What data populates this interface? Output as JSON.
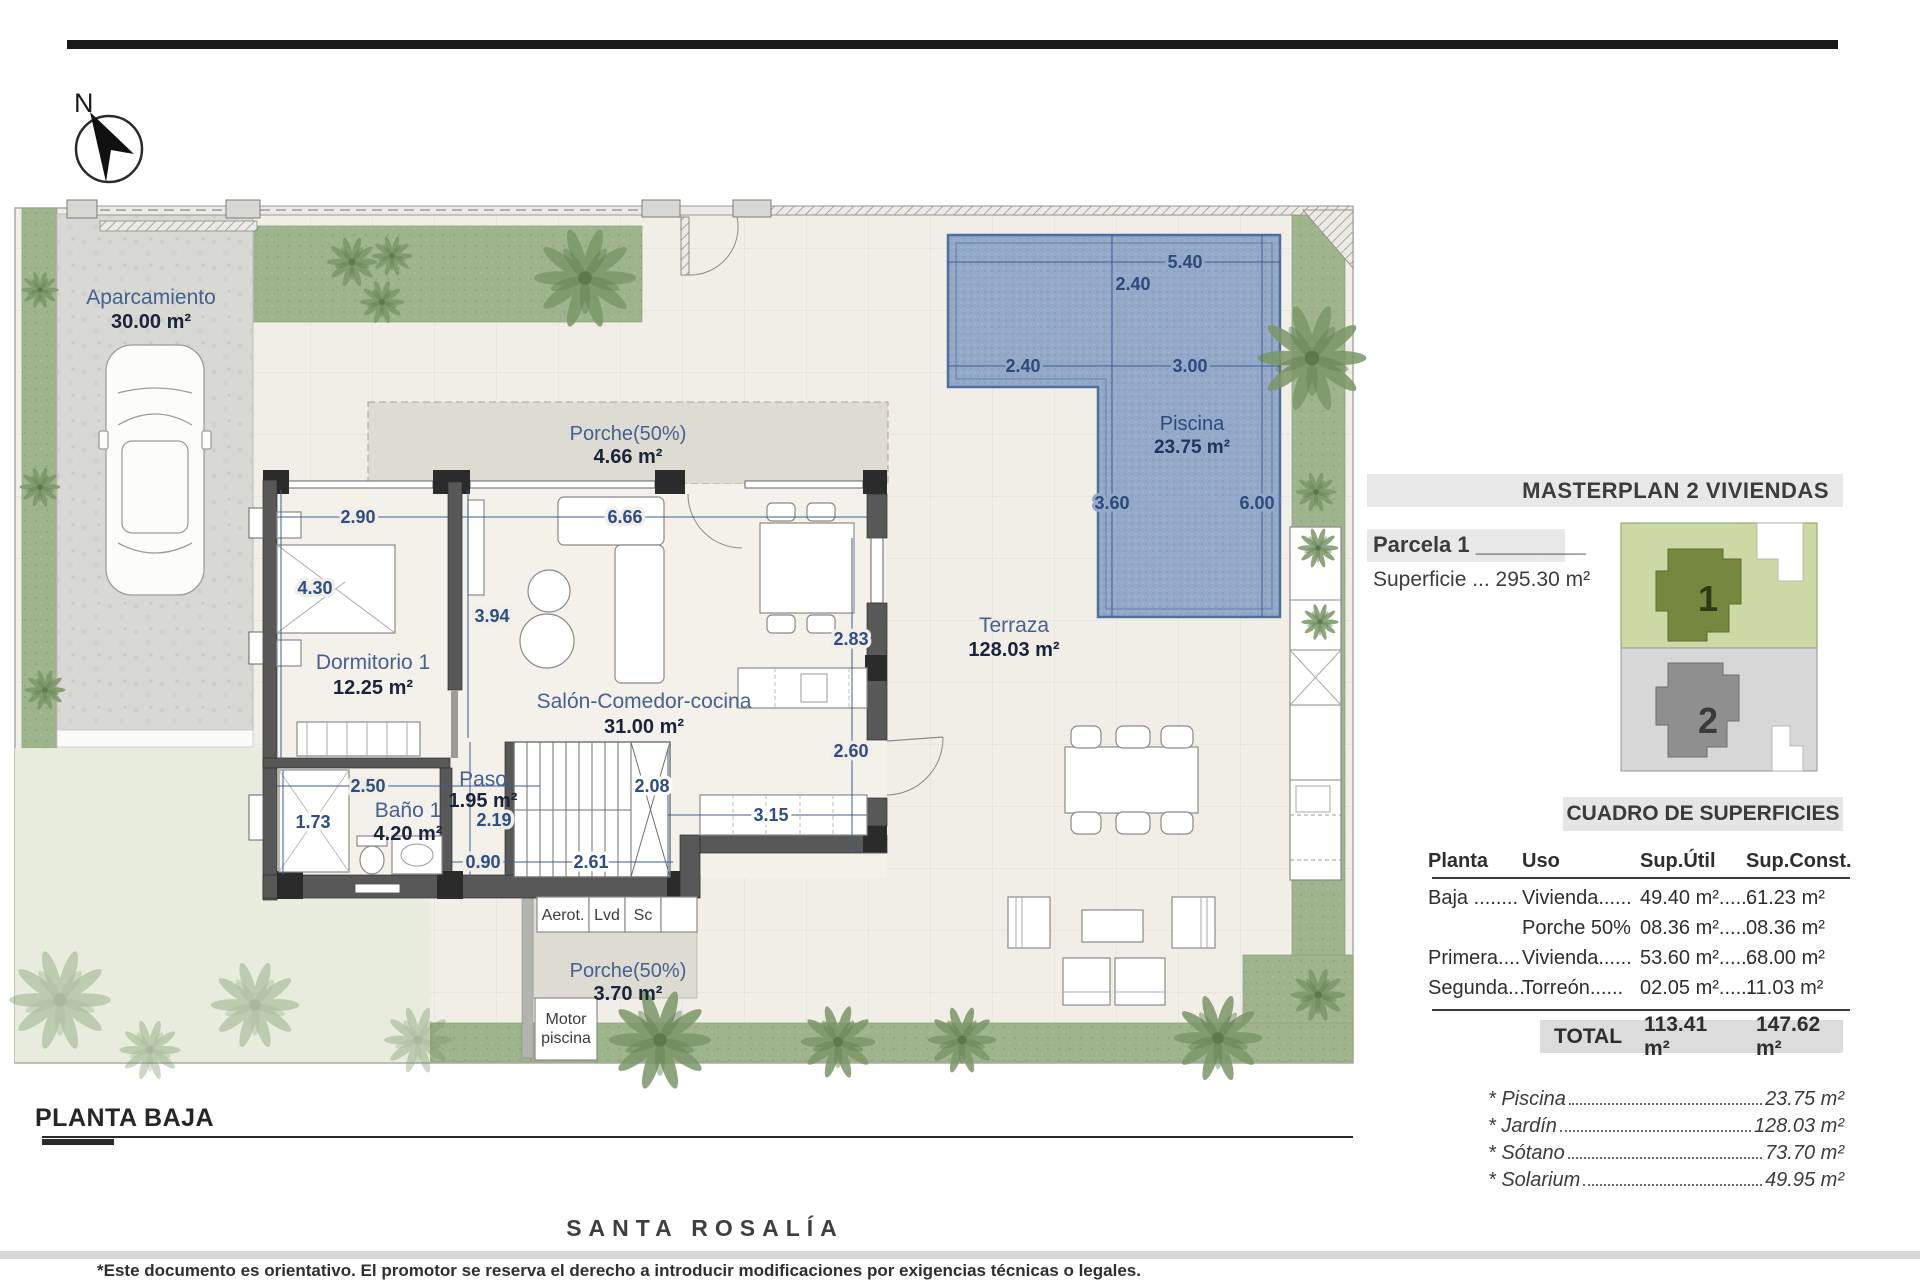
{
  "plan": {
    "north_label": "N",
    "title": "PLANTA BAJA",
    "rooms": {
      "aparcamiento": {
        "name": "Aparcamiento",
        "area": "30.00 m²"
      },
      "porche_norte": {
        "name": "Porche(50%)",
        "area": "4.66 m²"
      },
      "dormitorio": {
        "name": "Dormitorio 1",
        "area": "12.25 m²"
      },
      "salon": {
        "name": "Salón-Comedor-cocina",
        "area": "31.00 m²"
      },
      "bano": {
        "name": "Baño 1",
        "area": "4.20 m²"
      },
      "paso": {
        "name": "Paso",
        "area": "1.95 m²"
      },
      "terraza": {
        "name": "Terraza",
        "area": "128.03 m²"
      },
      "piscina": {
        "name": "Piscina",
        "area": "23.75 m²"
      },
      "porche_sur": {
        "name": "Porche(50%)",
        "area": "3.70 m²"
      }
    },
    "utility": {
      "aerot": "Aerot.",
      "lvd": "Lvd",
      "sc": "Sc",
      "motor1": "Motor",
      "motor2": "piscina"
    },
    "dims": {
      "dorm_w": "2.90",
      "salon_w": "6.66",
      "dorm_h": "4.30",
      "salon_h": "3.94",
      "bano_w": "2.50",
      "shower_h": "1.73",
      "paso_h": "2.19",
      "paso_w": "0.90",
      "stairs_w": "2.61",
      "stairs_h": "2.08",
      "kitchen_top": "2.83",
      "kitchen_bottom": "2.60",
      "counter_w": "3.15"
    },
    "pool_dims": {
      "top": "5.40",
      "left_w": "2.40",
      "left_h": "2.40",
      "right_w": "3.00",
      "lower_h": "3.60",
      "full_h": "6.00"
    }
  },
  "sidebar": {
    "masterplan_title": "MASTERPLAN 2 VIVIENDAS",
    "parcela_label": "Parcela 1 _________",
    "superficie": "Superficie ... 295.30 m²",
    "diagram": {
      "unit1": "1",
      "unit2": "2"
    },
    "table": {
      "title": "CUADRO DE SUPERFICIES",
      "headers": [
        "Planta",
        "Uso",
        "Sup.Útil",
        "Sup.Const."
      ],
      "rows": [
        {
          "planta": "Baja ........",
          "uso": "Vivienda......",
          "util": "49.40 m²......",
          "constr": "61.23 m²"
        },
        {
          "planta": "",
          "uso": "Porche 50%",
          "util": "08.36 m²......",
          "constr": "08.36 m²"
        },
        {
          "planta": "Primera....",
          "uso": "Vivienda......",
          "util": "53.60 m²......",
          "constr": "68.00 m²"
        },
        {
          "planta": "Segunda...",
          "uso": "Torreón......",
          "util": "02.05 m²......",
          "constr": "11.03 m²"
        }
      ],
      "total_label": "TOTAL",
      "total_util": "113.41 m²",
      "total_const": "147.62 m²"
    },
    "extras": [
      {
        "label": "* Piscina",
        "value": "23.75 m²"
      },
      {
        "label": "* Jardín",
        "value": "128.03 m²"
      },
      {
        "label": "* Sótano",
        "value": "73.70 m²"
      },
      {
        "label": "* Solarium",
        "value": "49.95 m²"
      }
    ]
  },
  "footer": {
    "brand": "SANTA ROSALÍA",
    "disclaimer": "*Este documento es orientativo. El promotor se reserva el derecho a introducir modificaciones por exigencias técnicas o legales."
  },
  "colors": {
    "accent_blue": "#44618f",
    "pool": "#94a9c7",
    "garden": "#9db48c",
    "wall": "#585858",
    "band_gray": "#e8e8e8"
  }
}
